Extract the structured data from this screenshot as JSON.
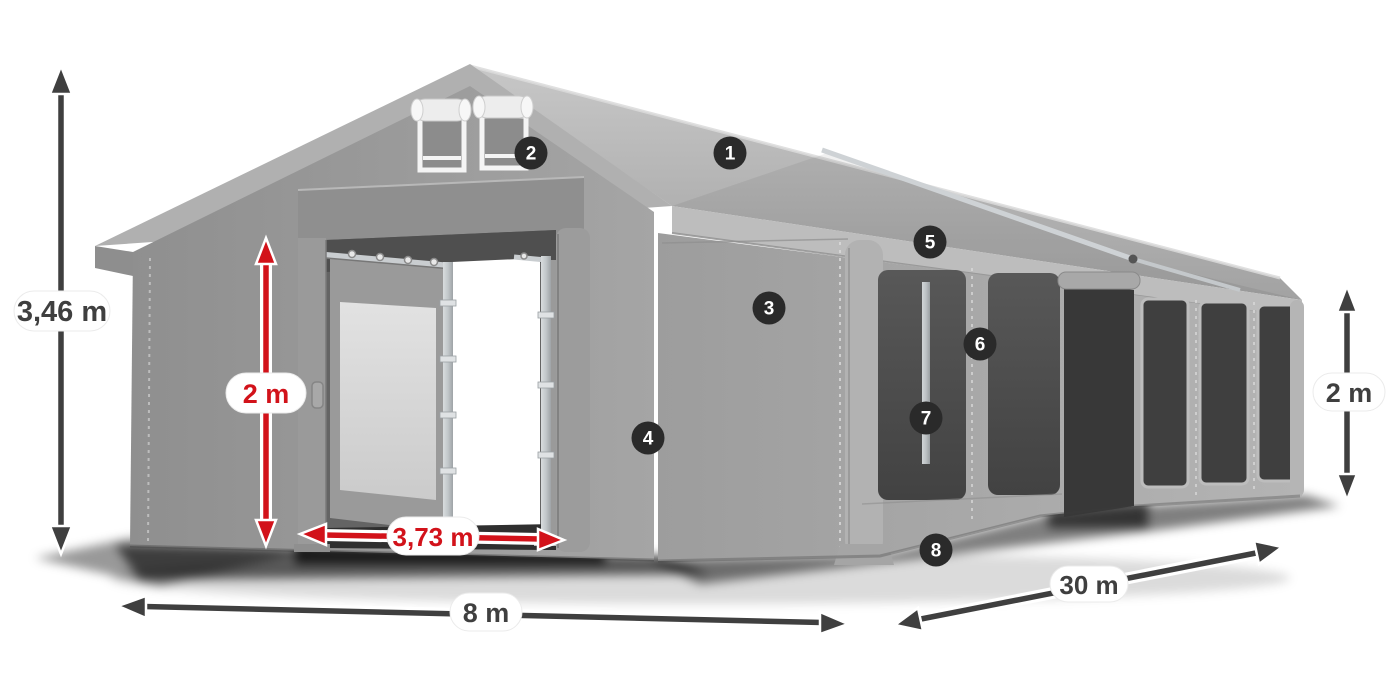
{
  "diagram": {
    "description": "Party tent 8 x 30 m dimensional diagram",
    "background_color": "#ffffff",
    "colors": {
      "dimension_dark": "#3f3f3f",
      "dimension_red": "#d2121a",
      "marker_background": "#2a2a2a",
      "marker_text": "#ffffff",
      "label_pill_background": "#ffffff",
      "tent_gray": "#a0a0a0"
    },
    "dimension_labels": {
      "total_height": "3,46 m",
      "door_height": "2 m",
      "door_width": "3,73 m",
      "tent_width": "8 m",
      "tent_length": "30 m",
      "side_height": "2 m"
    },
    "markers": [
      {
        "number": "1"
      },
      {
        "number": "2"
      },
      {
        "number": "3"
      },
      {
        "number": "4"
      },
      {
        "number": "5"
      },
      {
        "number": "6"
      },
      {
        "number": "7"
      },
      {
        "number": "8"
      }
    ]
  }
}
